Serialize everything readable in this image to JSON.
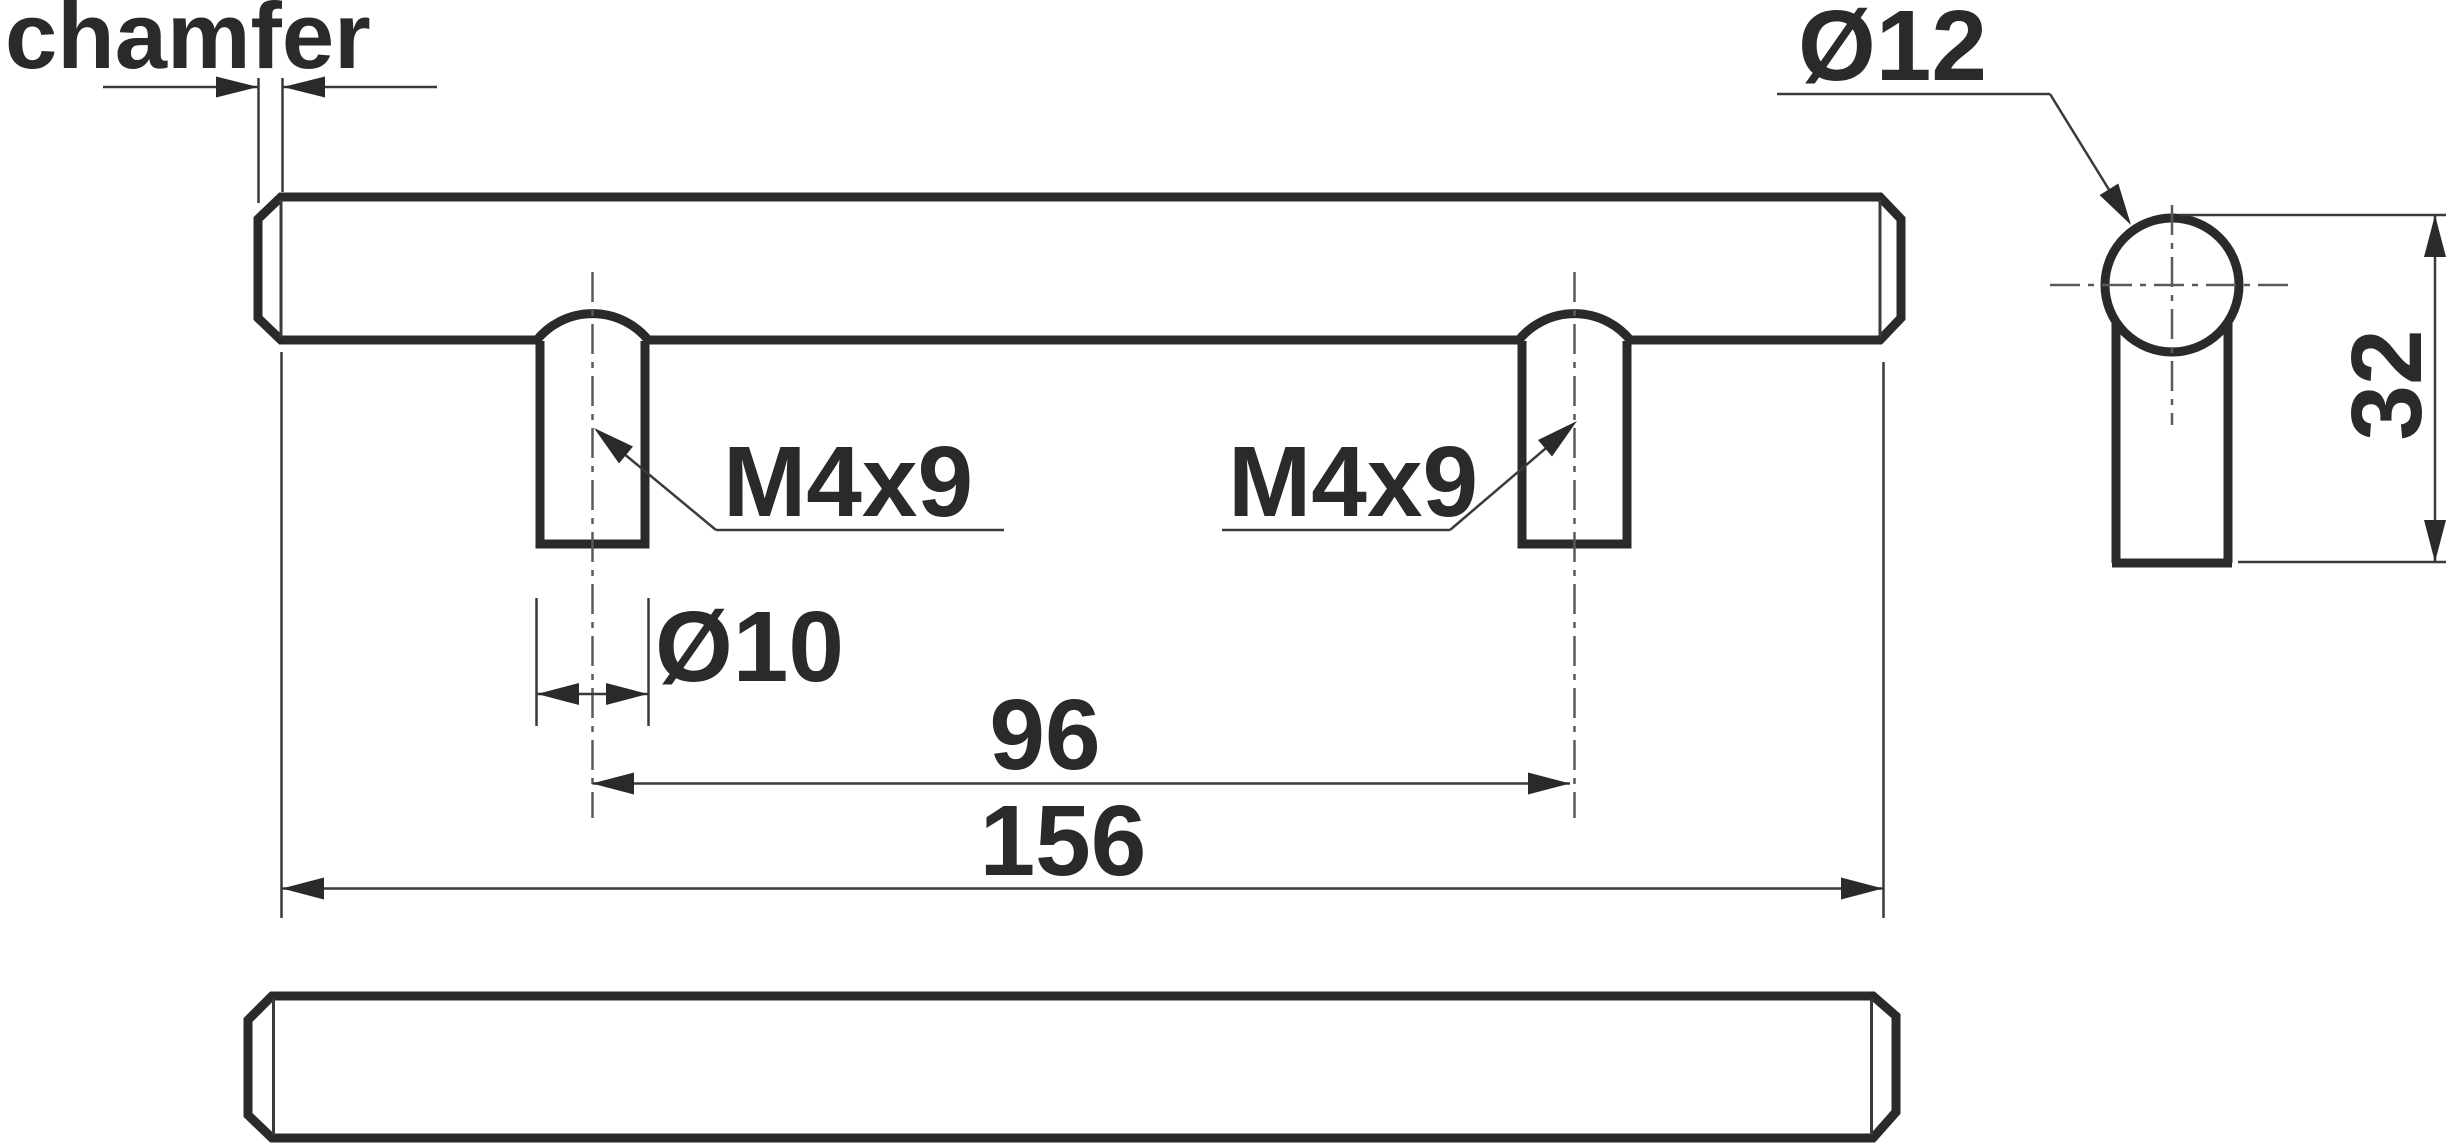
{
  "labels": {
    "chamfer": "chamfer",
    "bar_diameter": "Ø12",
    "thread_left": "M4x9",
    "thread_right": "M4x9",
    "post_diameter": "Ø10",
    "hole_spacing": "96",
    "overall_length": "156",
    "height": "32"
  },
  "colors": {
    "outline": "#2b2a29",
    "thin_line": "#3b3a39",
    "centerline": "#5a5a5a",
    "background": "#ffffff"
  }
}
